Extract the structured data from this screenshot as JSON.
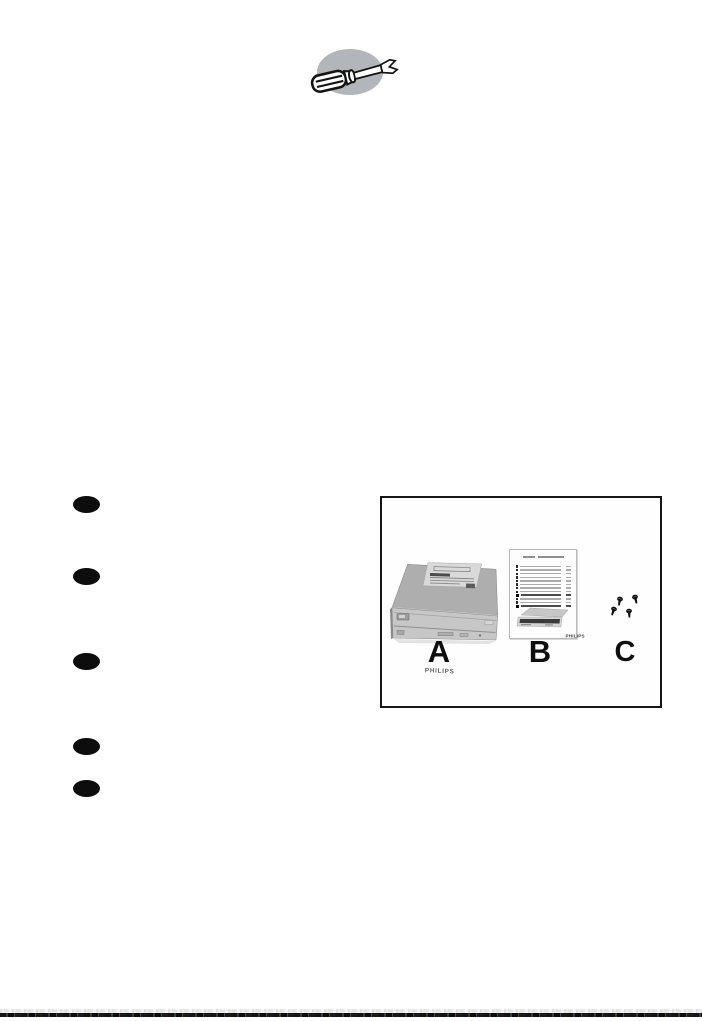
{
  "icons": {
    "screwdriver": {
      "name": "screwdriver-icon",
      "bg_color": "#b2b5b9"
    }
  },
  "bullet_list": {
    "count": 5
  },
  "kit_box": {
    "border_color": "#161616",
    "items": [
      {
        "id": "A",
        "label": "A",
        "name": "cd-rw-drive",
        "brand_text": "PHILIPS"
      },
      {
        "id": "B",
        "label": "B",
        "name": "quick-install-guide",
        "brand_text": "PHILIPS",
        "toc_row_count": 12,
        "toc_bold_rows": [
          9,
          12
        ]
      },
      {
        "id": "C",
        "label": "C",
        "name": "mounting-screws",
        "screw_count": 4
      }
    ]
  },
  "footer": {
    "cut_line_color": "#1a1a1a"
  }
}
